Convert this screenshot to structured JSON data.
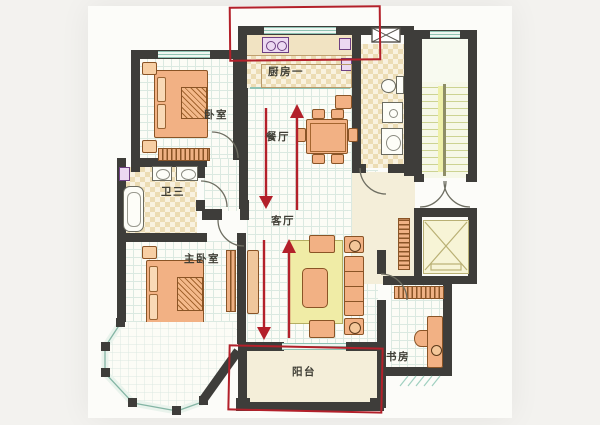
{
  "plan": {
    "rooms": {
      "bedroom": {
        "label": "卧室"
      },
      "kitchen": {
        "label": "厨房一"
      },
      "dining": {
        "label": "餐厅"
      },
      "bathroom": {
        "label": "卫三"
      },
      "living": {
        "label": "客厅"
      },
      "master_bedroom": {
        "label": "主卧室"
      },
      "study": {
        "label": "书房"
      },
      "balcony": {
        "label": "阳台"
      }
    },
    "colors": {
      "annotation_red": "#b3202a",
      "wall": "#3e3d3a",
      "furniture": "#f2b184",
      "furniture_outline": "#8a5426",
      "floor_checker": "#ecdcb4",
      "floor_grid_line": "#dbe9e1",
      "rug_yellow": "#f0eca6"
    }
  }
}
